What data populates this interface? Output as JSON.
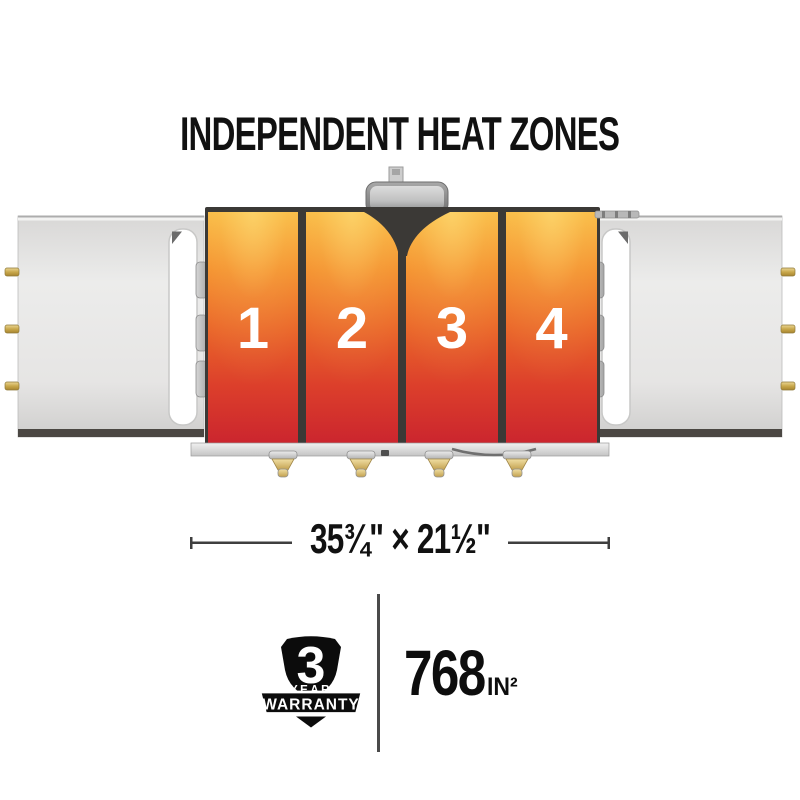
{
  "title": "INDEPENDENT HEAT ZONES",
  "griddle": {
    "zones": [
      {
        "label": "1"
      },
      {
        "label": "2"
      },
      {
        "label": "3"
      },
      {
        "label": "4"
      }
    ]
  },
  "dimension": {
    "label": "35¾\" × 21½\""
  },
  "warranty_badge": {
    "number": "3",
    "year_label": "YEAR",
    "warranty_label": "WARRANTY"
  },
  "cooking_area": {
    "value": "768",
    "unit": "IN²"
  },
  "icons": {
    "warranty_shield": "shield-icon"
  },
  "colors": {
    "heat_gradient_top": "#F9BB45",
    "heat_gradient_mid": "#EA672A",
    "heat_gradient_bottom": "#CB252E",
    "zone_divider": "#3B3936",
    "shelf_gray": "#E6E5E4",
    "shelf_edge_dark": "#4B4743",
    "brass_pin": "#C9A84C",
    "text_black": "#111111"
  }
}
